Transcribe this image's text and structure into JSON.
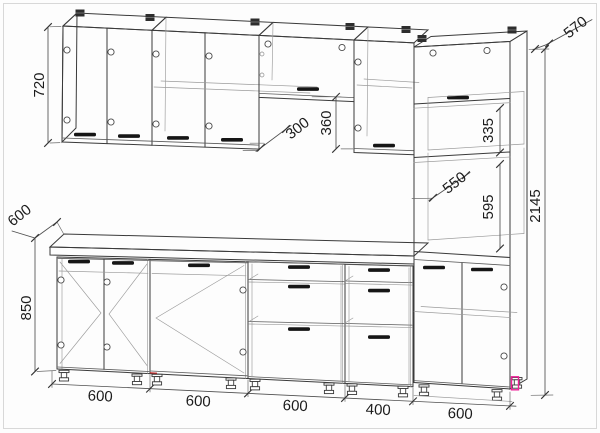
{
  "drawing": {
    "dimensions": {
      "wall_cabinet_height": "720",
      "countertop_depth": "600",
      "base_height": "850",
      "wall_cabinet_depth": "300",
      "wall_gap_height": "360",
      "tall_niche_height": "335",
      "tall_niche_depth": "550",
      "oven_niche_height": "595",
      "tall_unit_height": "2145",
      "tall_unit_depth": "570",
      "base_unit_widths": [
        "600",
        "600",
        "600",
        "400",
        "600"
      ]
    },
    "colors": {
      "line": "#3a3a3a",
      "dimension_line": "#4f4f4f",
      "text": "#1c1c1c",
      "highlight_marker": "#ee1f96",
      "page_frame": "#d8d8d8"
    }
  }
}
